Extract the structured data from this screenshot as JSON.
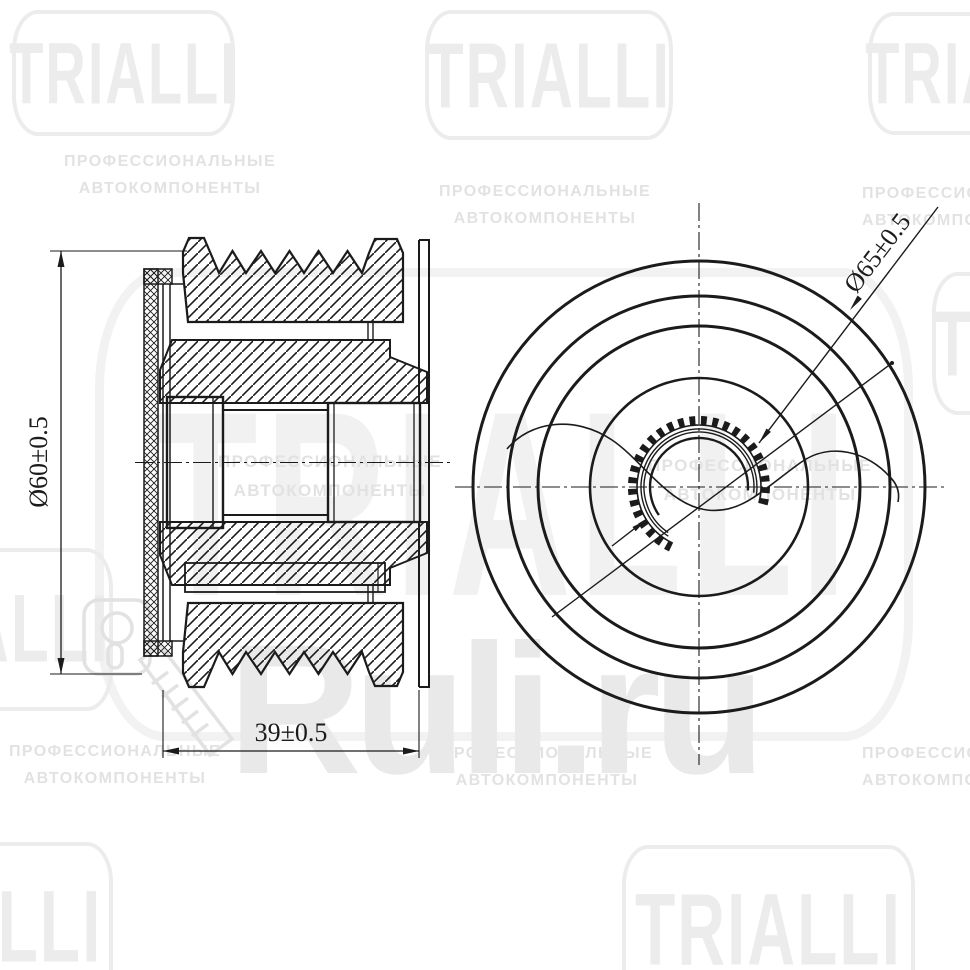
{
  "drawing": {
    "title": "alternator-freewheel-pulley-technical-drawing",
    "views": {
      "left": "cross-section side view",
      "right": "front view with partial break-out"
    },
    "dimensions": {
      "diameter_left": "Ø60±0.5",
      "width_bottom": "39±0.5",
      "diameter_right": "Ø65±0.5"
    },
    "line_color": "#1b1b1b",
    "background": "#ffffff"
  },
  "watermark": {
    "brand": "TRIALLI",
    "tagline_line1": "ПРОФЕССИОНАЛЬНЫЕ",
    "tagline_line2": "АВТОКОМПОНЕНТЫ",
    "site": "Ruli.ru",
    "icons": [
      "key-icon"
    ],
    "colors": {
      "badge": "#ececec",
      "tagline": "#e2e2e2",
      "site": "#e9e9e9"
    }
  }
}
